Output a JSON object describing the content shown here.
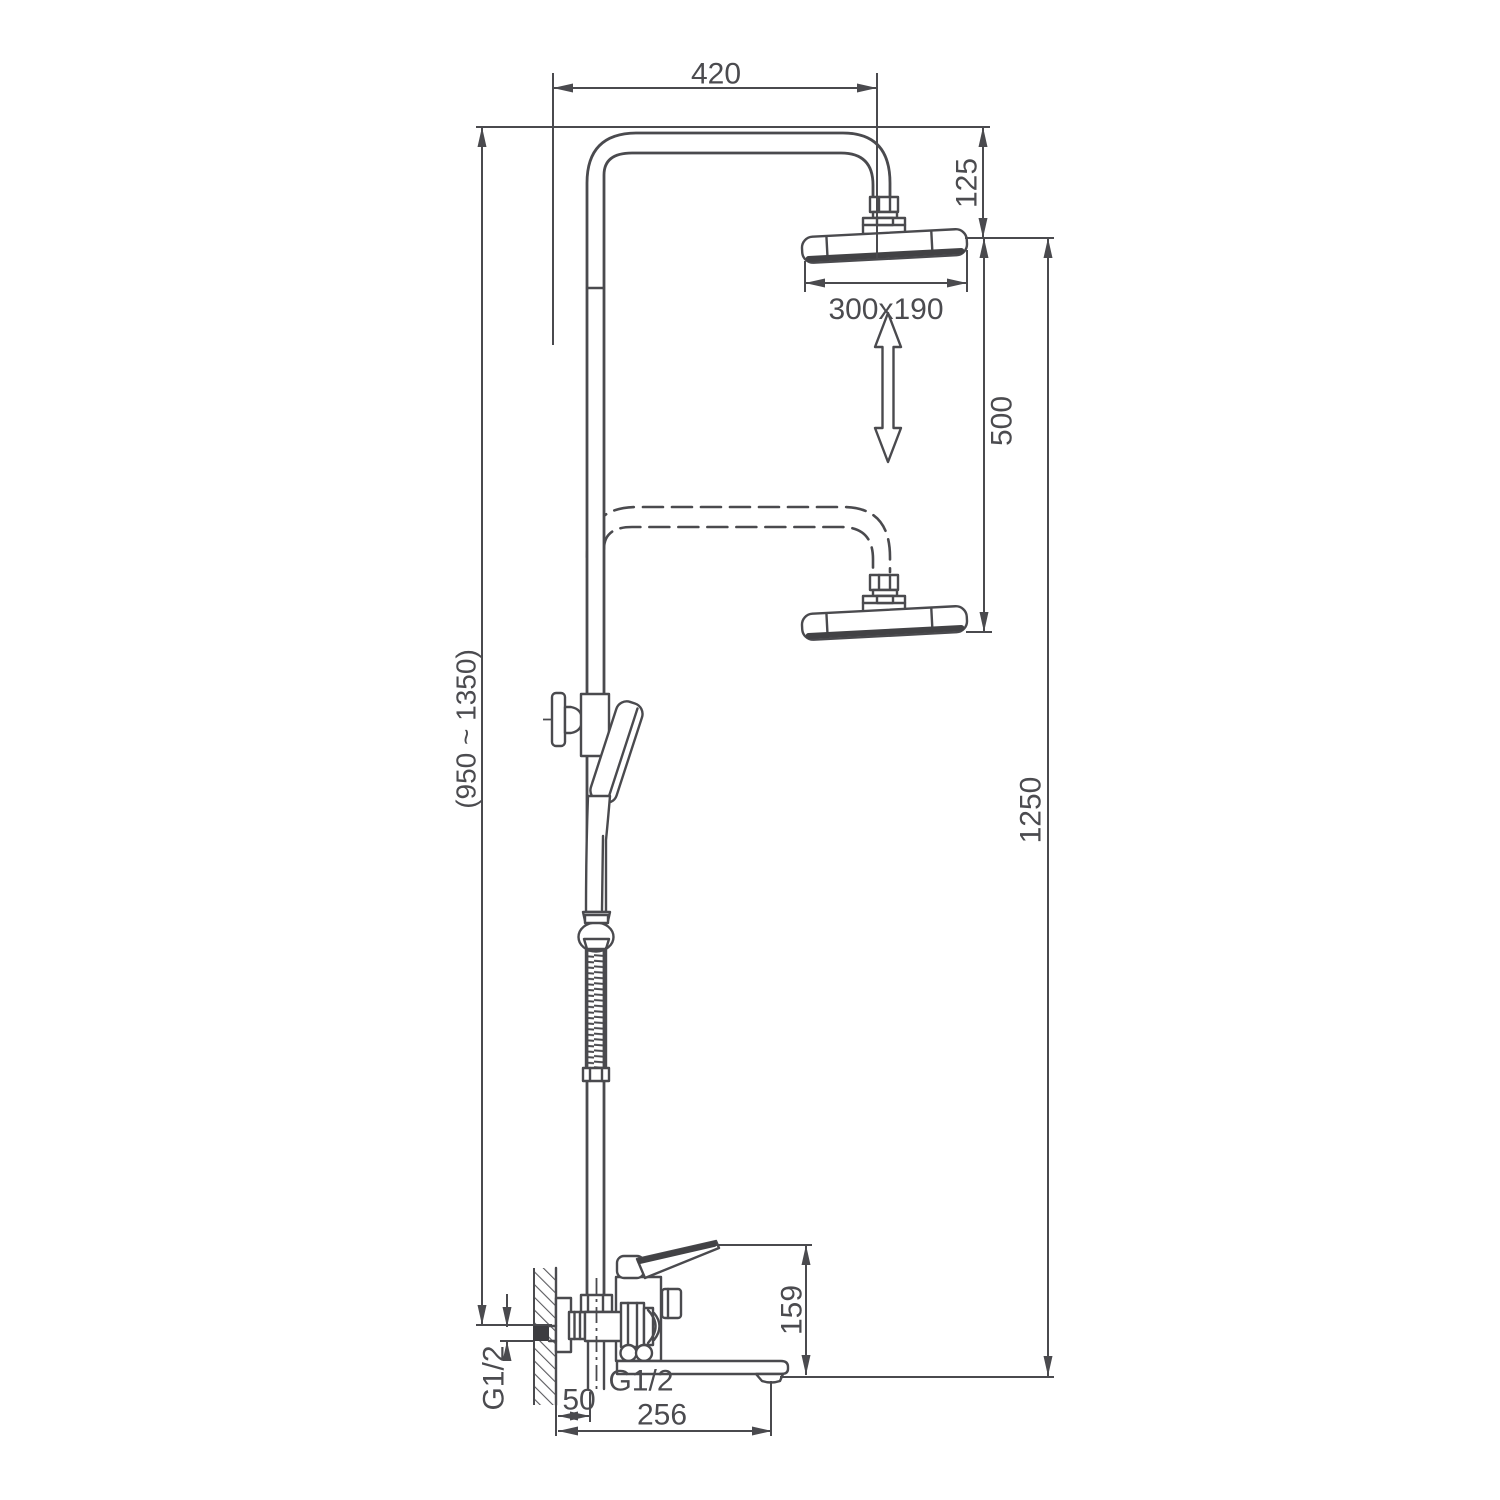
{
  "diagram": {
    "kind": "technical-dimension-drawing",
    "subject": "wall-mounted shower column with overhead shower, hand shower and bath spout",
    "colors": {
      "background": "#ffffff",
      "line": "#4a4a4e",
      "text": "#4b4b4f",
      "dark_accent": "#3c3c40"
    }
  },
  "dimensions": {
    "arm_reach": {
      "value": "420"
    },
    "head_offset": {
      "value": "125"
    },
    "head_size": {
      "value": "300x190"
    },
    "height_adjustment": {
      "value": "500"
    },
    "column_height": {
      "value": "1250"
    },
    "riser_height_range": {
      "value": "(950 ~ 1350)"
    },
    "spout_height": {
      "value": "159"
    },
    "inlet_thread": {
      "value": "G1/2"
    },
    "outlet_thread": {
      "value": "G1/2"
    },
    "wall_offset": {
      "value": "50"
    },
    "spout_reach": {
      "value": "256"
    }
  }
}
